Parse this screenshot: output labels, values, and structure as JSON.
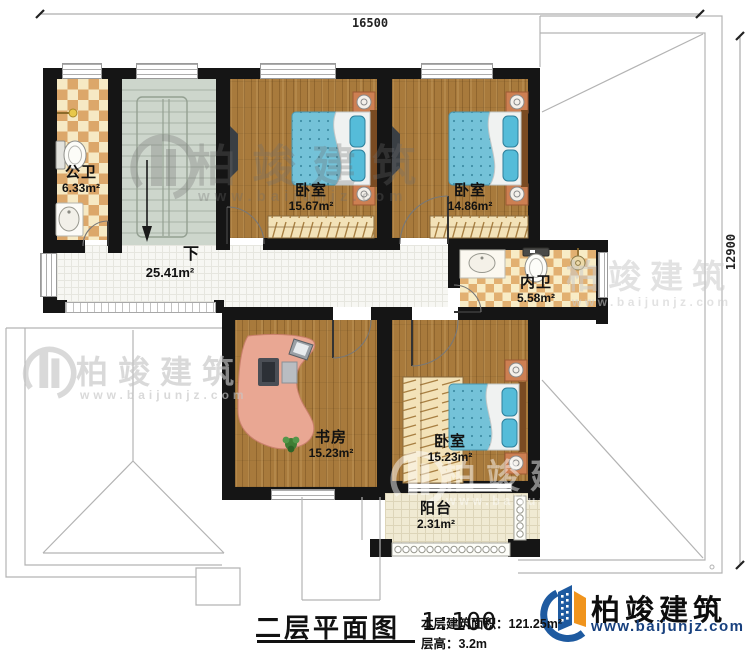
{
  "dimensions": {
    "width_label": "16500",
    "height_label": "12900"
  },
  "stairs": {
    "down_label": "下"
  },
  "rooms": {
    "public_bath": {
      "name": "公卫",
      "area": "6.33m²"
    },
    "bedroom_top_left": {
      "name": "卧室",
      "area": "15.67m²"
    },
    "bedroom_top_right": {
      "name": "卧室",
      "area": "14.86m²"
    },
    "inner_bath": {
      "name": "内卫",
      "area": "5.58m²"
    },
    "hallway": {
      "area": "25.41m²"
    },
    "study": {
      "name": "书房",
      "area": "15.23m²"
    },
    "bedroom_bottom": {
      "name": "卧室",
      "area": "15.23m²"
    },
    "balcony": {
      "name": "阳台",
      "area": "2.31m²"
    }
  },
  "title_block": {
    "title": "二层平面图",
    "scale": "1:100",
    "area_label": "本层建筑面积：",
    "area_value": "121.25m²",
    "height_label": "层高：",
    "height_value": "3.2m"
  },
  "brand": {
    "name": "柏竣建筑",
    "website": "www.baijunjz.com"
  },
  "watermark": {
    "name": "柏竣建筑",
    "website": "www.baijunjz.com"
  },
  "colors": {
    "wall": "#151515",
    "wood_floor": "#a87a3c",
    "mattress_blue": "#74c2d8",
    "brand_blue": "#1e5aa0",
    "brand_orange": "#f0941d"
  }
}
